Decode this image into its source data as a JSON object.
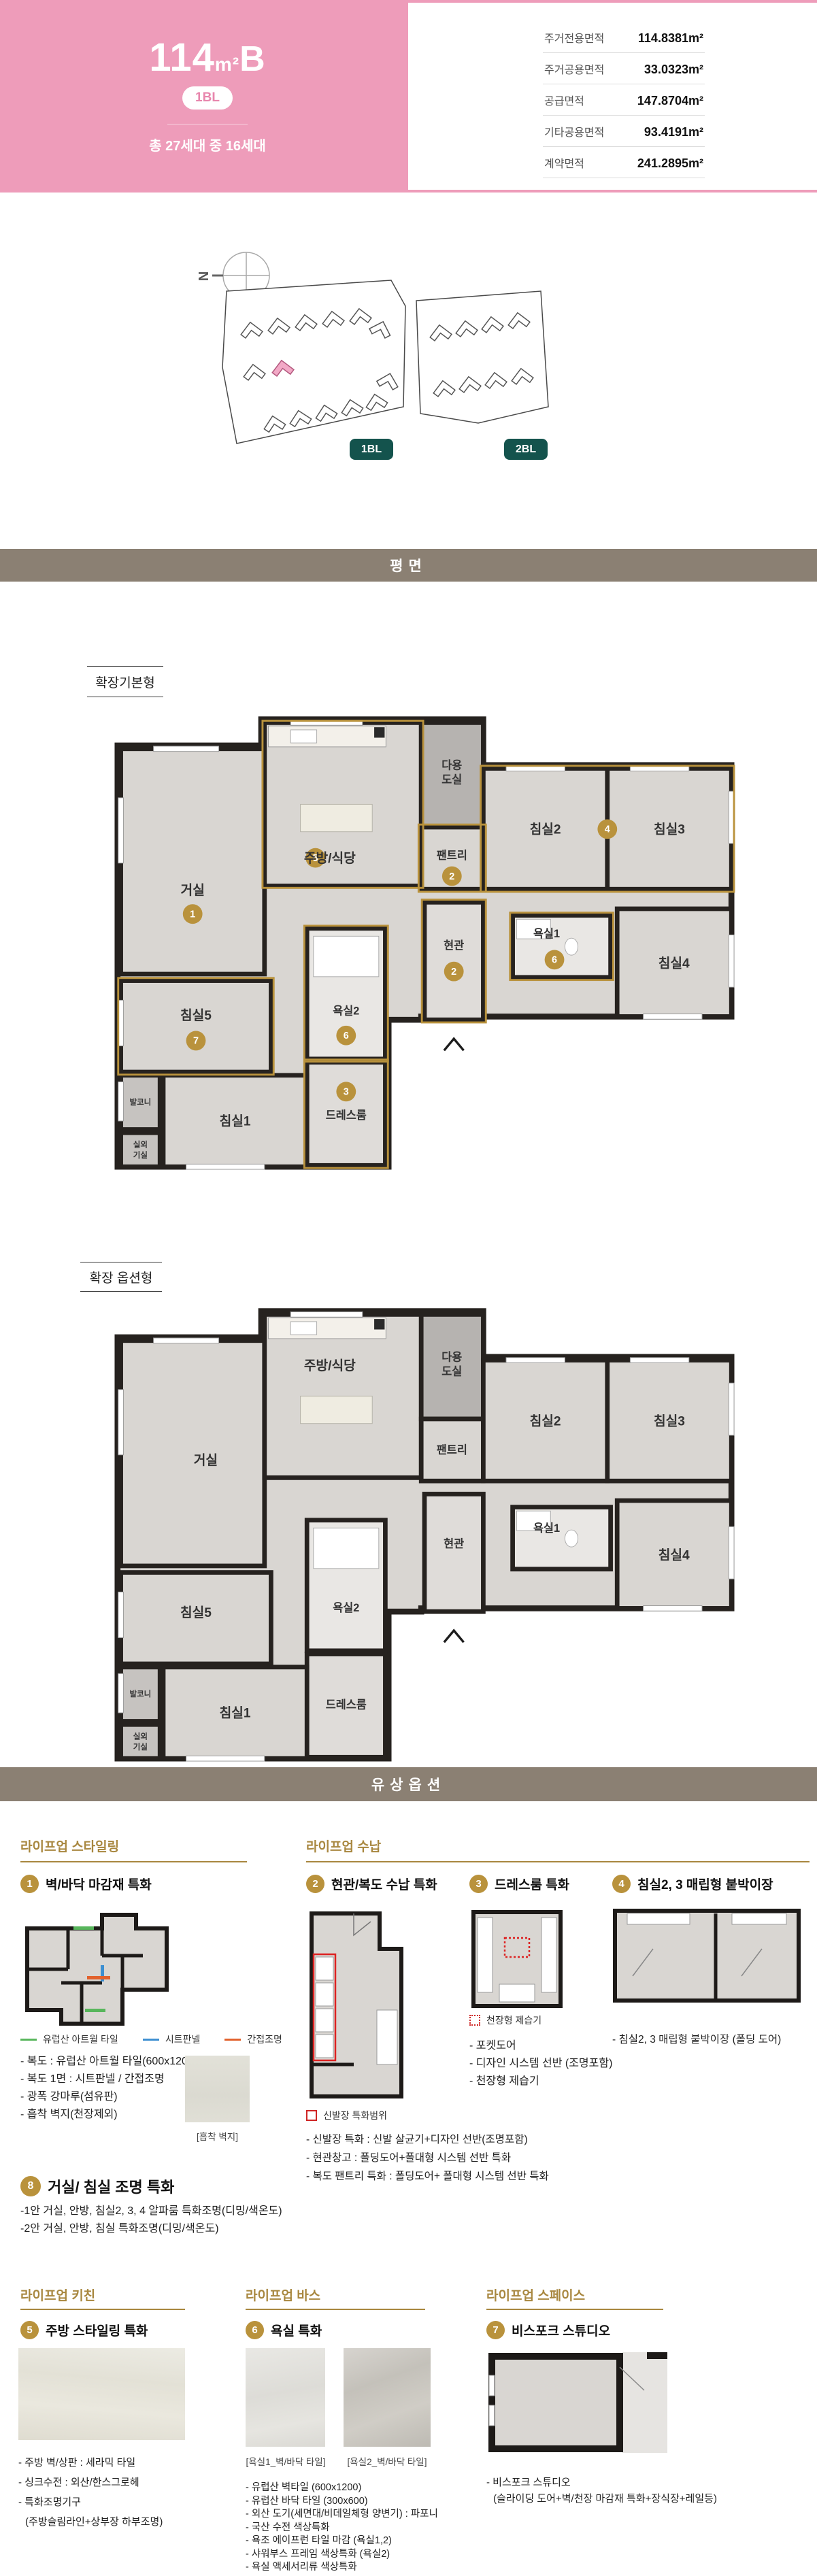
{
  "colors": {
    "hero_pink": "#ee9cba",
    "badge_text_pink": "#e886ad",
    "bar_taupe": "#8b8073",
    "gold_heading": "#a8873f",
    "gold_marker": "#b9923c",
    "teal_badge": "#14534d",
    "wall": "#26221f",
    "floor": "#d9d6d2",
    "site_highlight": "#f2a9c6",
    "legend_green": "#58b65c",
    "legend_blue": "#3d8fd1",
    "legend_orange": "#e2622d",
    "legend_red": "#cf2525"
  },
  "hero": {
    "title_num": "114",
    "title_unit": "m²",
    "title_suffix": "B",
    "badge": "1BL",
    "households": "총 27세대 중 16세대",
    "area_table": [
      {
        "label": "주거전용면적",
        "value": "114.8381m²"
      },
      {
        "label": "주거공용면적",
        "value": "33.0323m²"
      },
      {
        "label": "공급면적",
        "value": "147.8704m²"
      },
      {
        "label": "기타공용면적",
        "value": "93.4191m²"
      },
      {
        "label": "계약면적",
        "value": "241.2895m²"
      }
    ]
  },
  "site": {
    "compass": "N",
    "badge1": "1BL",
    "badge2": "2BL"
  },
  "bars": {
    "plan": "평면",
    "options": "유상옵션"
  },
  "plans": {
    "label_basic": "확장기본형",
    "label_option": "확장 옵션형",
    "rooms": {
      "living": "거실",
      "kitchen": "주방/식당",
      "utility1": "다용",
      "utility2": "도실",
      "pantry": "팬트리",
      "bed2": "침실2",
      "bed3": "침실3",
      "bed4": "침실4",
      "bed5": "침실5",
      "bath1": "욕실1",
      "bath2": "욕실2",
      "entry": "현관",
      "balcony": "발코니",
      "bed1": "침실1",
      "ac1": "실외",
      "ac2": "기실",
      "dress": "드레스룸"
    },
    "numbers": {
      "living": "1",
      "kitchen": "5",
      "pantry": "2",
      "bed23": "4",
      "entry": "2",
      "bath1": "6",
      "bed5": "7",
      "bath2": "6",
      "dress": "3"
    }
  },
  "options": {
    "groups": {
      "styling": "라이프업 스타일링",
      "storage": "라이프업 수납",
      "kitchen": "라이프업 키친",
      "bath": "라이프업 바스",
      "space": "라이프업 스페이스"
    },
    "opt1": {
      "num": "1",
      "title": "벽/바닥 마감재 특화",
      "legend": [
        {
          "color": "#58b65c",
          "label": "유럽산 아트월 타일"
        },
        {
          "color": "#3d8fd1",
          "label": "시트판넬"
        },
        {
          "color": "#e2622d",
          "label": "간접조명"
        }
      ],
      "bullets": [
        "- 복도 : 유럽산 아트월 타일(600x1200)",
        "- 복도 1면 : 시트판넬 / 간접조명",
        "- 광폭 강마루(섬유판)",
        "- 흡착 벽지(천장제외)"
      ],
      "swatch_caption": "[흡착 벽지]"
    },
    "opt2": {
      "num": "2",
      "title": "현관/복도 수납 특화",
      "legend": "신발장 특화범위",
      "bullets": [
        "- 신발장 특화 : 신발 살균기+디자인 선반(조명포함)",
        "- 현관창고 : 폴딩도어+폴대형 시스템 선반 특화",
        "- 복도 팬트리 특화 : 폴딩도어+ 폴대형 시스템 선반 특화"
      ]
    },
    "opt3": {
      "num": "3",
      "title": "드레스룸 특화",
      "legend": "천장형 제습기",
      "bullets": [
        "- 포켓도어",
        "- 디자인 시스템 선반 (조명포함)",
        "- 천장형 제습기"
      ]
    },
    "opt4": {
      "num": "4",
      "title": "침실2, 3 매립형 붙박이장",
      "bullets": [
        "- 침실2, 3 매립형 붙박이장 (폴딩 도어)"
      ]
    },
    "opt8": {
      "num": "8",
      "title": "거실/ 침실 조명 특화",
      "bullets": [
        "-1안 거실, 안방, 침실2, 3, 4 알파룸 특화조명(디밍/색온도)",
        "-2안 거실, 안방, 침실 특화조명(디밍/색온도)"
      ]
    },
    "opt5": {
      "num": "5",
      "title": "주방 스타일링 특화",
      "bullets": [
        "- 주방 벽/상판 : 세라믹 타일",
        "- 싱크수전 : 외산/한스그로헤",
        "- 특화조명기구",
        "(주방슬림라인+상부장 하부조명)"
      ]
    },
    "opt6": {
      "num": "6",
      "title": "욕실 특화",
      "captions": [
        "[욕실1_벽/바닥 타일]",
        "[욕실2_벽/바닥 타일]"
      ],
      "bullets": [
        "- 유럽산 벽타일 (600x1200)",
        "- 유럽산 바닥 타일 (300x600)",
        "- 외산 도기(세면대/비데일체형 양변기) : 파포니",
        "- 국산 수전 색상특화",
        "- 욕조 에이프런 타일 마감 (욕실1,2)",
        "- 샤워부스 프레임 색상특화 (욕실2)",
        "- 욕실 액세서리류 색상특화"
      ]
    },
    "opt7": {
      "num": "7",
      "title": "비스포크 스튜디오",
      "bullets": [
        "- 비스포크 스튜디오",
        "(슬라이딩 도어+벽/천장 마감재 특화+장식장+레일등)"
      ]
    }
  }
}
